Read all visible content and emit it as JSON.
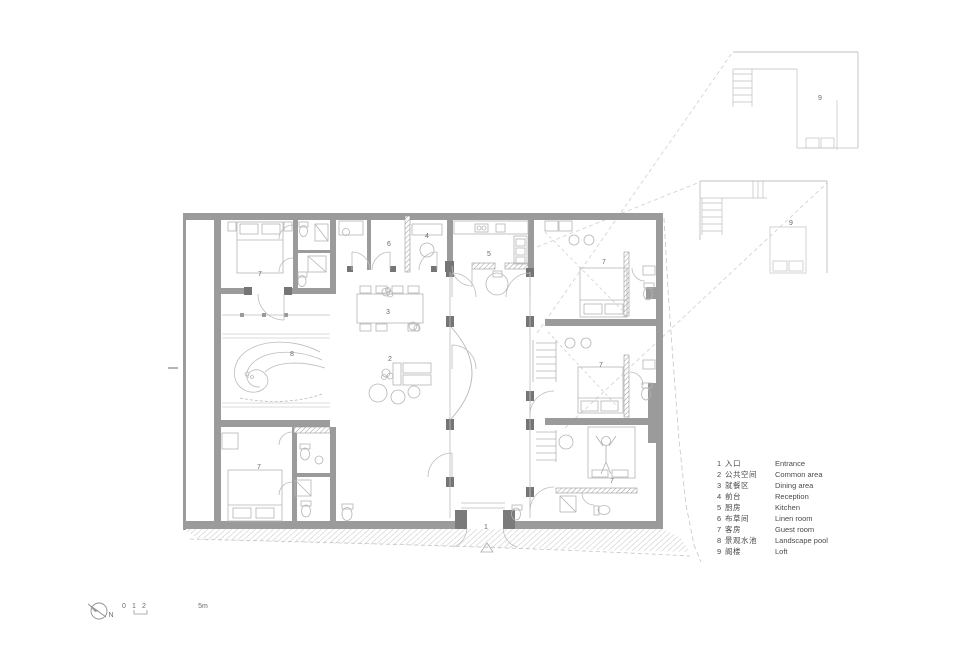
{
  "colors": {
    "wall": "#9b9b9b",
    "thin_line": "#b5b5b5",
    "dashed_line": "#cccccc",
    "jamb": "#757575",
    "label_text": "#6b6b6b",
    "legend_text": "#4a4a4a"
  },
  "plan": {
    "labels": {
      "entrance": "1",
      "common_area": "2",
      "dining_area": "3",
      "reception": "4",
      "kitchen": "5",
      "linen_room": "6",
      "guest_room": "7",
      "landscape_pool": "8",
      "loft": "9"
    }
  },
  "legend": {
    "items": [
      {
        "num": "1",
        "zh": "入口",
        "en": "Entrance"
      },
      {
        "num": "2",
        "zh": "公共空间",
        "en": "Common area"
      },
      {
        "num": "3",
        "zh": "就餐区",
        "en": "Dining area"
      },
      {
        "num": "4",
        "zh": "前台",
        "en": "Reception"
      },
      {
        "num": "5",
        "zh": "厨房",
        "en": "Kitchen"
      },
      {
        "num": "6",
        "zh": "布草间",
        "en": "Linen room"
      },
      {
        "num": "7",
        "zh": "客房",
        "en": "Guest room"
      },
      {
        "num": "8",
        "zh": "景观水池",
        "en": "Landscape pool"
      },
      {
        "num": "9",
        "zh": "阁楼",
        "en": "Loft"
      }
    ]
  },
  "scale_bar": {
    "tick0": "0",
    "tick1": "1",
    "tick2": "2",
    "unit_label": "5m"
  },
  "north": {
    "label": "N"
  }
}
